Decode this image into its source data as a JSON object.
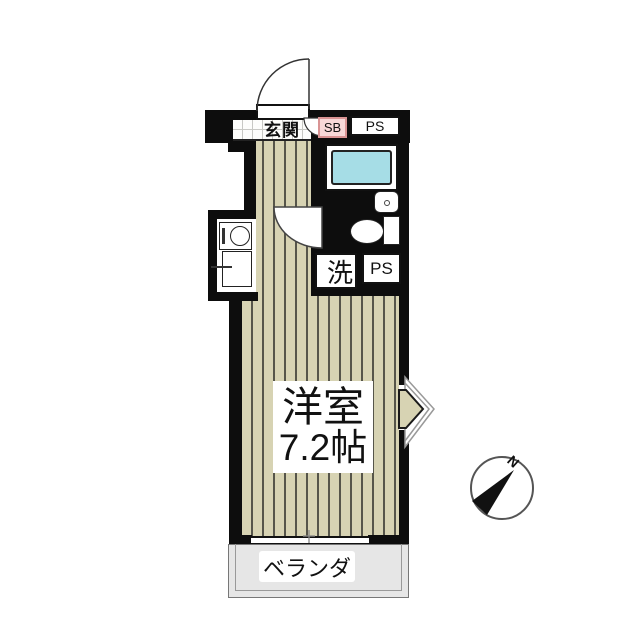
{
  "plan": {
    "entrance": {
      "label": "玄関"
    },
    "shoe_box": {
      "label": "SB"
    },
    "pipe_space_top": {
      "label": "PS"
    },
    "laundry": {
      "label": "洗"
    },
    "pipe_space_mid": {
      "label": "PS"
    },
    "main_room": {
      "name": "洋室",
      "size": "7.2帖"
    },
    "balcony": {
      "label": "ベランダ"
    },
    "compass": {
      "north": "N"
    }
  },
  "colors": {
    "wall": "#0d0d0d",
    "floor": "#d7d3b3",
    "floor_line": "#56554a",
    "genkan_line": "#c8c8c4",
    "tile": "#b5b9e6",
    "tile_line": "#a2a6d8",
    "tub": "#a6dde6",
    "sb_fill": "#f7d8d8",
    "sb_border": "#d99494",
    "balcony_fill": "#e6e6e6"
  }
}
